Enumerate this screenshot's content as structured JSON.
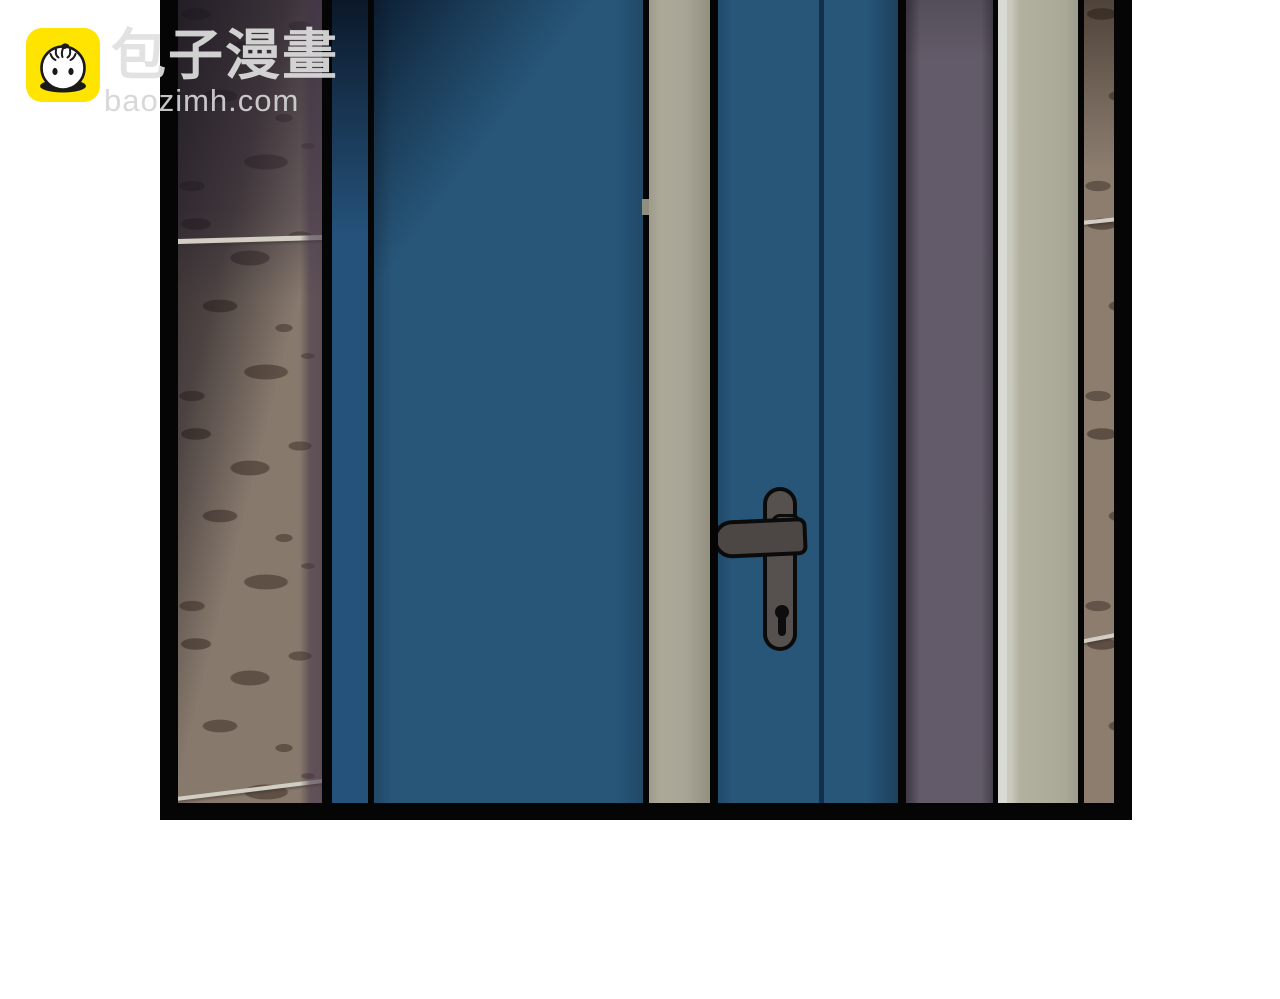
{
  "watermark": {
    "brand": "包子漫畫",
    "domain": "baozimh.com",
    "logo_icon": "baozi-bun-icon",
    "logo_background": "#FFE400",
    "logo_line_color": "#1a1a1a",
    "text_color": "#dfdfdf"
  },
  "scene": {
    "type": "comic-panel",
    "subject": "closed blue double door in a hallway",
    "panel_border_color": "#050505",
    "background_color": "#ffffff",
    "palette": {
      "door_blue": "#275679",
      "door_stile_shadow": "#0a1a2e",
      "door_seam_navy": "#152e4a",
      "frame_board_gray": "#a5a294",
      "handle_gray": "#56514e",
      "handle_outline": "#0b0b0b",
      "wall_left_tan": "#87796c",
      "wall_mottle_dark": "#54463b",
      "wall_purple_tint": "#4a3c50",
      "wall_purple_strip": "#635b69",
      "trim_highlight_white": "#dadad5",
      "trim_sage": "#aaa998",
      "wall_right_brown": "#8c7d6f",
      "tile_seam_light": "#d2cec4"
    }
  }
}
